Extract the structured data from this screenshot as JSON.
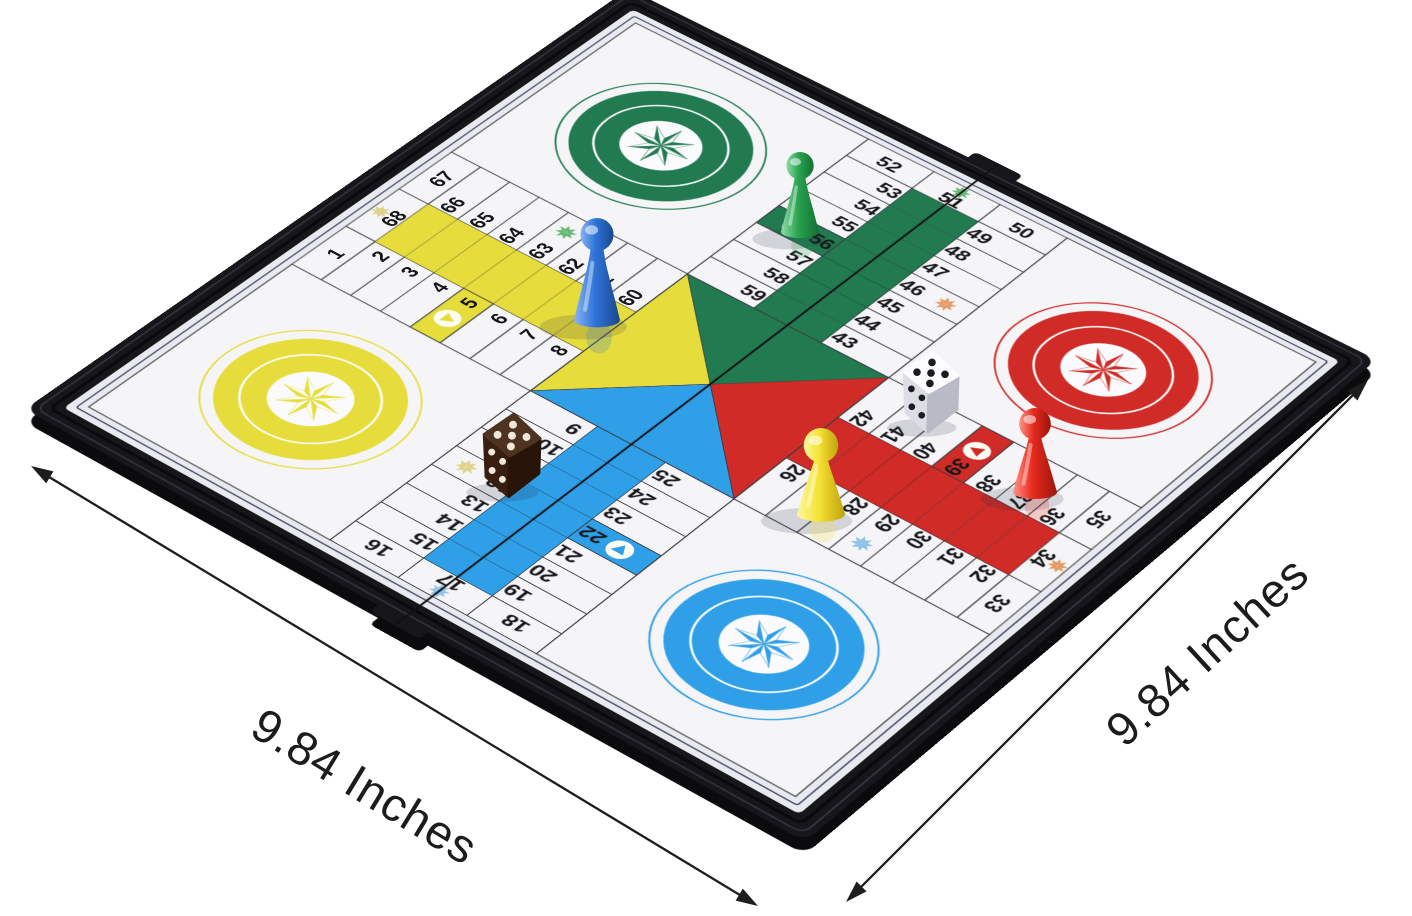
{
  "scene": {
    "background": "#ffffff"
  },
  "dimension_labels": {
    "bottom": {
      "text": "9.84 Inches",
      "x": 365,
      "y": 786,
      "rotation_deg": 31.3,
      "arrow": {
        "x1": 31,
        "y1": 466,
        "x2": 758,
        "y2": 906
      }
    },
    "right": {
      "text": "9.84 Inches",
      "x": 1207,
      "y": 651,
      "rotation_deg": -42.5,
      "arrow": {
        "x1": 846,
        "y1": 902,
        "x2": 1368,
        "y2": 380
      }
    }
  },
  "board": {
    "frame_color": "#17171b",
    "frame_ridge_light": "#34343e",
    "frame_ridge_dark": "#0a0a0c",
    "surface_color": "#e9eaef",
    "cell_fill": "#f5f5f8",
    "grid_line_color": "#3c3c44",
    "inner_border_color": "#26264a",
    "seam_color": "#101014",
    "number_color": "#17171a",
    "colors": {
      "yellow": "#e6dd3c",
      "green": "#217a50",
      "red": "#d02b27",
      "blue": "#2f9fe8"
    },
    "star_colors": {
      "pale_yellow": "#ddd38a",
      "green": "#66b873",
      "light_blue": "#8fc3ea",
      "orange": "#e59a67"
    },
    "quadrants": [
      {
        "position": "top-left",
        "color": "green"
      },
      {
        "position": "top-right",
        "color": "red"
      },
      {
        "position": "bottom-right",
        "color": "blue"
      },
      {
        "position": "bottom-left",
        "color": "yellow"
      }
    ],
    "center_triangles": [
      {
        "arm": "left",
        "color": "yellow"
      },
      {
        "arm": "top",
        "color": "green"
      },
      {
        "arm": "right",
        "color": "red"
      },
      {
        "arm": "bottom",
        "color": "blue"
      }
    ],
    "arms": {
      "left": {
        "corridor": "yellow",
        "side_a": [
          66,
          65,
          64,
          63,
          62,
          61,
          60
        ],
        "side_b": [
          2,
          3,
          4,
          5,
          6,
          7,
          8
        ],
        "edge": [
          67,
          68,
          1
        ],
        "edge_star_color": "pale_yellow",
        "side_star": {
          "side": "a",
          "index": 3,
          "color": "green",
          "number": 63
        },
        "start": {
          "side": "b",
          "index": 3,
          "color": "yellow",
          "number": 5
        }
      },
      "top": {
        "corridor": "green",
        "side_a": [
          53,
          54,
          55,
          56,
          57,
          58,
          59
        ],
        "side_b": [
          49,
          48,
          47,
          46,
          45,
          44,
          43
        ],
        "edge": [
          52,
          51,
          50
        ],
        "edge_star_color": "green",
        "side_star": {
          "side": "b",
          "index": 3,
          "color": "orange",
          "number": 46
        },
        "start": {
          "side": "a",
          "index": 3,
          "color": "green",
          "number": 56
        }
      },
      "right": {
        "corridor": "red",
        "side_a": [
          32,
          31,
          30,
          29,
          28,
          27,
          26
        ],
        "side_b": [
          36,
          37,
          38,
          39,
          40,
          41,
          42
        ],
        "edge": [
          33,
          34,
          35
        ],
        "edge_star_color": "orange",
        "side_star": {
          "side": "a",
          "index": 3,
          "color": "light_blue",
          "number": 29
        },
        "start": {
          "side": "b",
          "index": 3,
          "color": "red",
          "number": 39
        }
      },
      "bottom": {
        "corridor": "blue",
        "side_a": [
          19,
          20,
          21,
          22,
          23,
          24,
          25
        ],
        "side_b": [
          15,
          14,
          13,
          12,
          11,
          10,
          9
        ],
        "edge": [
          18,
          17,
          16
        ],
        "edge_star_color": "light_blue",
        "side_star": {
          "side": "b",
          "index": 3,
          "color": "pale_yellow",
          "number": 12
        },
        "start": {
          "side": "a",
          "index": 3,
          "color": "blue",
          "number": 22
        }
      }
    },
    "safe_star_cells": [
      12,
      17,
      29,
      34,
      46,
      51,
      63,
      68
    ],
    "start_cells": [
      5,
      22,
      39,
      56
    ]
  },
  "pieces": {
    "pawns": [
      {
        "color_name": "blue",
        "on_cell": "yellow home column",
        "x": 597,
        "y": 320,
        "height": 102,
        "width": 46,
        "fill": "#2f74d9",
        "light": "#8ab4f2",
        "dark": "#1a478f"
      },
      {
        "color_name": "green",
        "on_cell": "56",
        "x": 800,
        "y": 232,
        "height": 80,
        "width": 38,
        "fill": "#2aa351",
        "light": "#8fdba8",
        "dark": "#137032"
      },
      {
        "color_name": "yellow",
        "on_cell": "28",
        "x": 821,
        "y": 514,
        "height": 86,
        "width": 48,
        "fill": "#f6e233",
        "light": "#fcf7a0",
        "dark": "#bfa40e"
      },
      {
        "color_name": "red",
        "on_cell": "37",
        "x": 1035,
        "y": 492,
        "height": 84,
        "width": 44,
        "fill": "#e52a1d",
        "light": "#ff9488",
        "dark": "#9c150c"
      }
    ],
    "dice": [
      {
        "color_name": "white",
        "x": 930,
        "y": 383,
        "size": 56,
        "top_face": 5,
        "front_face": 4,
        "face_top": "#fcfcfe",
        "face_front": "#dcdde5",
        "face_right": "#b9bac6",
        "pip": "#1b1b20"
      },
      {
        "color_name": "dark-brown",
        "x": 511,
        "y": 446,
        "size": 58,
        "top_face": 5,
        "front_face": 4,
        "face_top": "#4e3320",
        "face_front": "#371e0f",
        "face_right": "#281408",
        "pip": "#efe9dc"
      }
    ]
  }
}
